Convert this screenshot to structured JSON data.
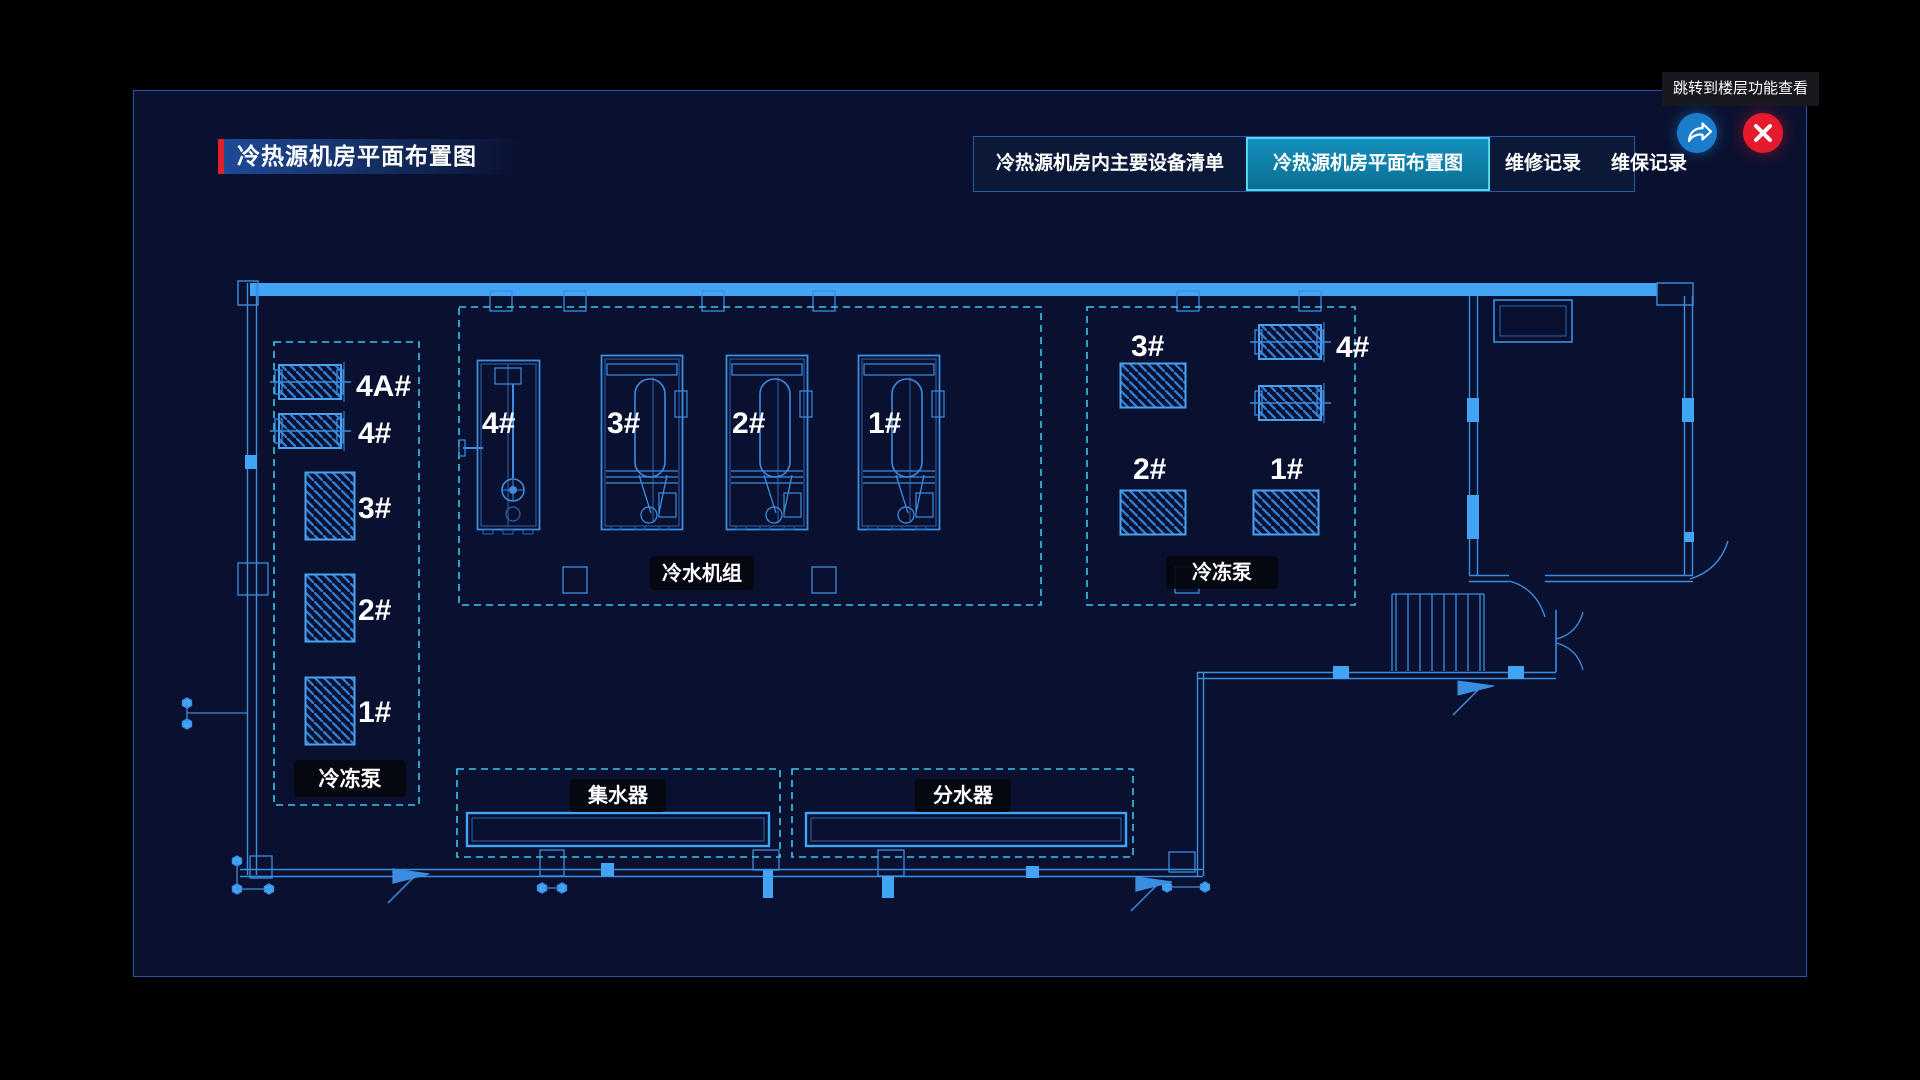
{
  "header": {
    "title": "冷热源机房平面布置图"
  },
  "tabs": [
    {
      "label": "冷热源机房内主要设备清单",
      "active": false
    },
    {
      "label": "冷热源机房平面布置图",
      "active": true
    },
    {
      "label": "维修记录",
      "active": false
    },
    {
      "label": "维保记录",
      "active": false
    }
  ],
  "window": {
    "tooltip": "跳转到楼层功能查看",
    "jump_icon": "share-arrow-icon",
    "close_icon": "close-x-icon"
  },
  "plan": {
    "left_pump_zone": {
      "name": "冷冻泵",
      "units": [
        "4A#",
        "4#",
        "3#",
        "2#",
        "1#"
      ]
    },
    "chiller_zone": {
      "name": "冷水机组",
      "units": [
        "4#",
        "3#",
        "2#",
        "1#"
      ]
    },
    "right_pump_zone": {
      "name": "冷冻泵",
      "units": [
        "3#",
        "4#",
        "2#",
        "1#"
      ]
    },
    "collector_zone": {
      "name": "集水器"
    },
    "distributor_zone": {
      "name": "分水器"
    }
  },
  "colors": {
    "title_accent_red": "#e0222f",
    "active_tab_teal": "#1490bc",
    "active_tab_border": "#55d6f2",
    "jump_button_blue": "#1b7ccb",
    "close_button_red": "#e51a2c",
    "plan_line_blue": "#3a8de0",
    "plan_bright_blue": "#42a4f4",
    "zone_dash_cyan": "#38c8ec",
    "panel_background": "#0a1130"
  }
}
